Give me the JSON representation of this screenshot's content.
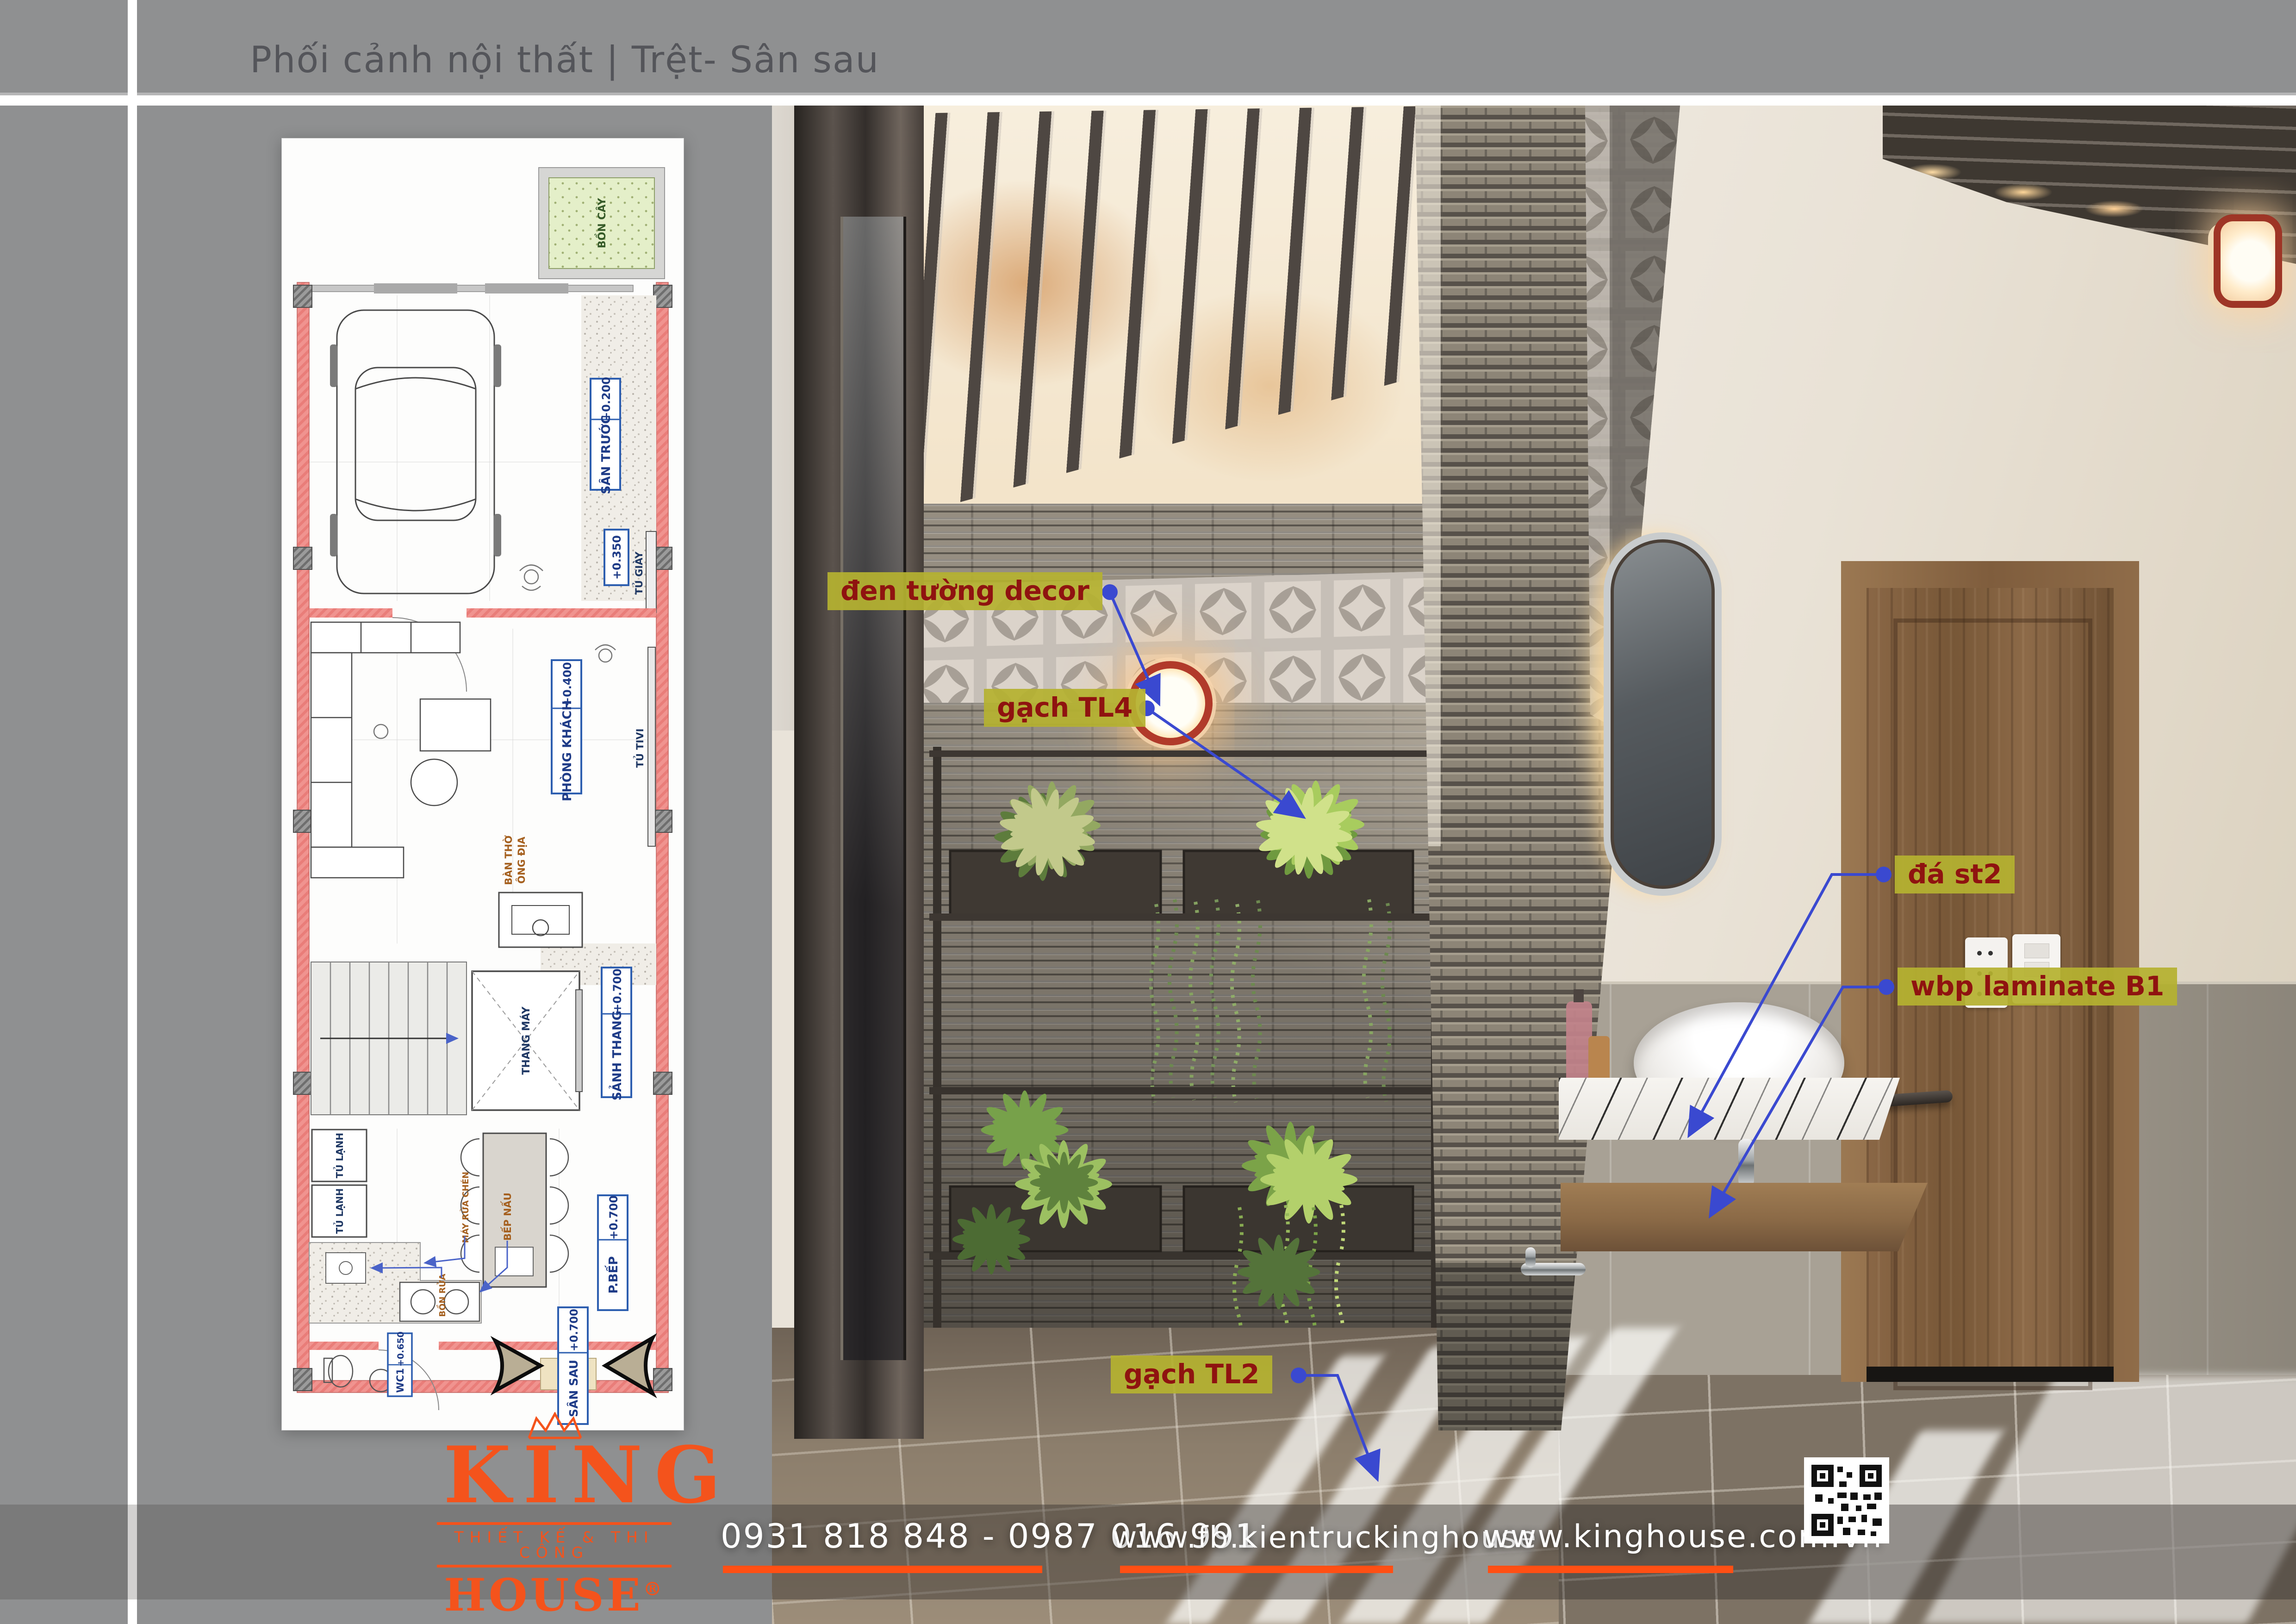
{
  "page": {
    "title": "Phối cảnh nội thất | Trệt- Sân sau"
  },
  "colors": {
    "accent_orange": "#F95A1E",
    "annotation_bg": "#B5B230",
    "annotation_text": "#8F1310",
    "leader_blue": "#3A49D0",
    "plan_wall_pink": "#F0938F",
    "plan_label_blue": "#2E5FB0",
    "page_gray": "#8F9091"
  },
  "labels": [
    {
      "text": "đen tường decor"
    },
    {
      "text": "gạch TL4"
    },
    {
      "text": "đá st2"
    },
    {
      "text": "wbp laminate B1"
    },
    {
      "text": "gạch TL2"
    }
  ],
  "plan": {
    "bon_cay": "BỒN CÂY",
    "san_truoc": "SÂN TRƯỚC",
    "san_truoc_lv": "+0.200",
    "lv_0350": "+0.350",
    "tu_giay": "TỦ GIÀY",
    "phong_khach": "PHÒNG KHÁCH",
    "phong_khach_lv": "+0.400",
    "tu_tivi": "TỦ TIVI",
    "ban_tho_1": "BÀN THỜ",
    "ban_tho_2": "ÔNG ĐỊA",
    "thang_may": "THANG MÁY",
    "sanh_thang": "SẢNH THANG",
    "sanh_thang_lv": "+0.700",
    "tu_lanh": "TỦ LẠNH",
    "p_bep": "P.BẾP",
    "p_bep_lv": "+0.700",
    "bep_nau": "BẾP NẤU",
    "may_rua_chen": "MÁY RỬA CHÉN",
    "bon_rua": "BỒN RỬA",
    "wc1": "WC1",
    "wc1_lv": "+0.650",
    "san_sau": "SÂN SAU",
    "san_sau_lv": "+0.700"
  },
  "brand": {
    "king": "KING",
    "tagline": "THIẾT KẾ & THI CÔNG",
    "house": "HOUSE",
    "reg": "®"
  },
  "footer": {
    "phones": "0931 818 848 - 0987 016 991",
    "facebook": "www.fb.kientruckinghouse",
    "website": "www.kinghouse.com.vn"
  }
}
